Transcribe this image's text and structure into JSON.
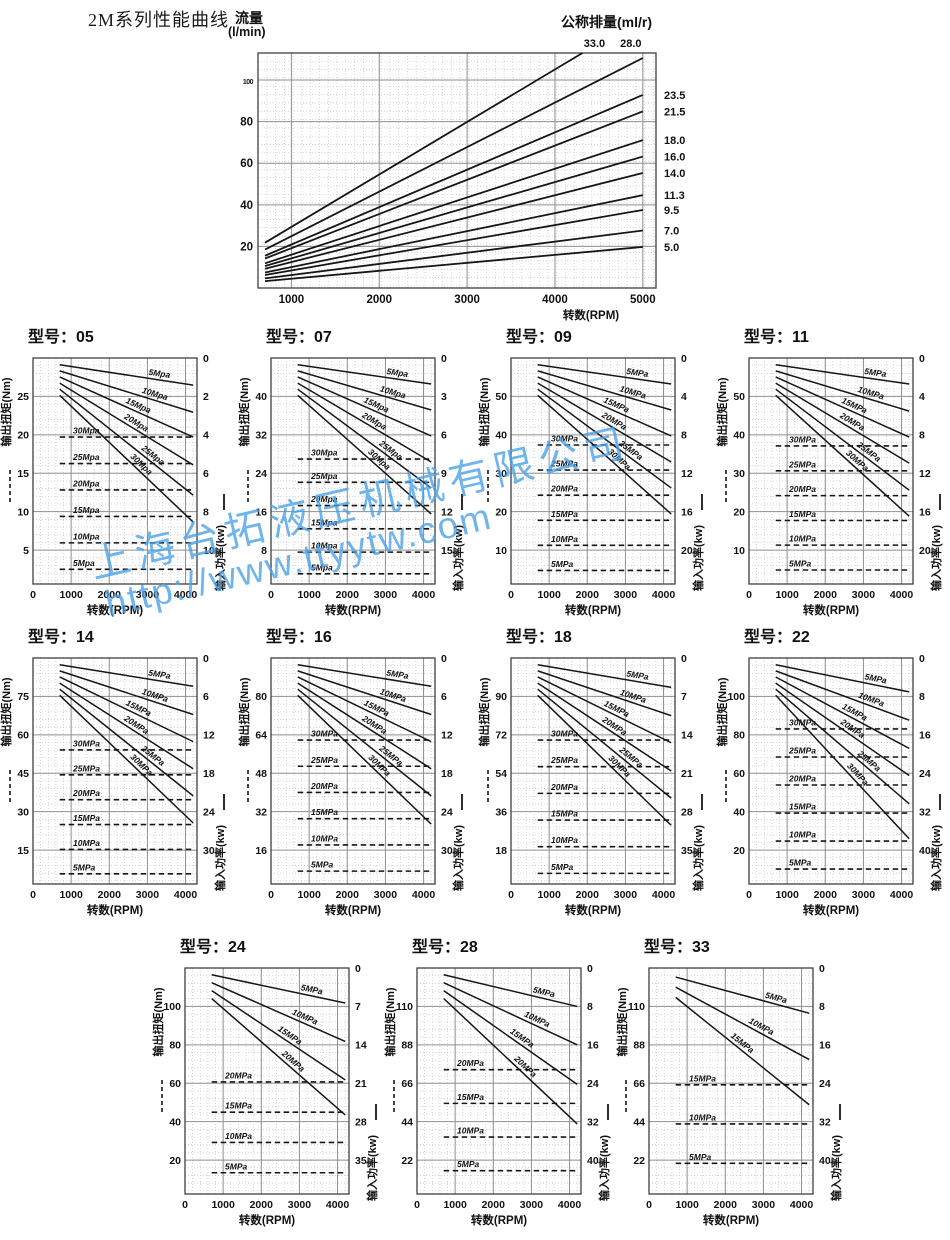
{
  "page": {
    "title": "2M系列性能曲线"
  },
  "watermark": {
    "line1": "上海台拓液压机械有限公司",
    "line2": "http://www.ttyytw.com",
    "color": "#49a0e8"
  },
  "colors": {
    "line": "#161616",
    "grid_major": "#8f8f8f",
    "grid_minor": "#c6c6c6",
    "border": "#3f3f3f"
  },
  "chart_data": {
    "top": {
      "type": "line",
      "title_left_1": "流量",
      "title_left_2": "(l/min)",
      "title_right": "公称排量(ml/r)",
      "xlabel": "转数(RPM)",
      "x_ticks": [
        "1000",
        "2000",
        "3000",
        "4000",
        "5000"
      ],
      "y_ticks": [
        "20",
        "40",
        "60",
        "80",
        "100"
      ],
      "x_range_rpm": [
        620,
        5150
      ],
      "y_range_flow": [
        0,
        113
      ],
      "flow_model": {
        "rpm_start": 700,
        "rpm_end": 5000,
        "k_start": 0.66,
        "k_end": 3.95
      },
      "series": [
        {
          "label": "33.0",
          "d": 33.0,
          "label_pos": "top"
        },
        {
          "label": "28.0",
          "d": 28.0,
          "label_pos": "top"
        },
        {
          "label": "23.5",
          "d": 23.5,
          "label_pos": "right"
        },
        {
          "label": "21.5",
          "d": 21.5,
          "label_pos": "right"
        },
        {
          "label": "18.0",
          "d": 18.0,
          "label_pos": "right"
        },
        {
          "label": "16.0",
          "d": 16.0,
          "label_pos": "right"
        },
        {
          "label": "14.0",
          "d": 14.0,
          "label_pos": "right"
        },
        {
          "label": "11.3",
          "d": 11.3,
          "label_pos": "right"
        },
        {
          "label": "9.5",
          "d": 9.5,
          "label_pos": "right"
        },
        {
          "label": "7.0",
          "d": 7.0,
          "label_pos": "right"
        },
        {
          "label": "5.0",
          "d": 5.0,
          "label_pos": "right"
        }
      ]
    },
    "common": {
      "xlabel": "转数(RPM)",
      "x_ticks": [
        "0",
        "1000",
        "2000",
        "3000",
        "4000"
      ],
      "x_range_rpm": [
        0,
        4300
      ],
      "line_start_rpm": 700,
      "line_end_rpm": 4200,
      "left_axis_label": "输出扭矩(Nm)",
      "right_axis_label": "输入功率(kw)"
    },
    "models": [
      {
        "id": "05",
        "title": "型号：05",
        "left_ticks": [
          "25",
          "20",
          "15",
          "10",
          "5"
        ],
        "right_ticks": [
          "0",
          "2",
          "4",
          "6",
          "8",
          "10"
        ],
        "solid": [
          {
            "label": "5Mpa",
            "s": 0.03,
            "e": 0.12
          },
          {
            "label": "10Mpa",
            "s": 0.057,
            "e": 0.24
          },
          {
            "label": "15Mpa",
            "s": 0.084,
            "e": 0.35
          },
          {
            "label": "20Mpa",
            "s": 0.111,
            "e": 0.473
          },
          {
            "label": "25Mpa",
            "s": 0.138,
            "e": 0.607
          },
          {
            "label": "30Mpa",
            "s": 0.165,
            "e": 0.726
          }
        ],
        "dashed": [
          {
            "label": "30Mpa",
            "f": 0.35
          },
          {
            "label": "25Mpa",
            "f": 0.467
          },
          {
            "label": "20Mpa",
            "f": 0.584
          },
          {
            "label": "15Mpa",
            "f": 0.701
          },
          {
            "label": "10Mpa",
            "f": 0.818
          },
          {
            "label": "5Mpa",
            "f": 0.935
          }
        ]
      },
      {
        "id": "07",
        "title": "型号：07",
        "left_ticks": [
          "40",
          "32",
          "24",
          "16",
          "8"
        ],
        "right_ticks": [
          "0",
          "3",
          "6",
          "9",
          "12",
          "15"
        ],
        "solid": [
          {
            "label": "5Mpa",
            "s": 0.03,
            "e": 0.115
          },
          {
            "label": "10Mpa",
            "s": 0.057,
            "e": 0.23
          },
          {
            "label": "15Mpa",
            "s": 0.084,
            "e": 0.345
          },
          {
            "label": "20Mpa",
            "s": 0.111,
            "e": 0.46
          },
          {
            "label": "25Mpa",
            "s": 0.138,
            "e": 0.575
          },
          {
            "label": "30Mpa",
            "s": 0.165,
            "e": 0.69
          }
        ],
        "dashed": [
          {
            "label": "30Mpa",
            "f": 0.447
          },
          {
            "label": "25Mpa",
            "f": 0.55
          },
          {
            "label": "20Mpa",
            "f": 0.653
          },
          {
            "label": "15Mpa",
            "f": 0.756
          },
          {
            "label": "10Mpa",
            "f": 0.859
          },
          {
            "label": "5Mpa",
            "f": 0.955
          }
        ]
      },
      {
        "id": "09",
        "title": "型号：09",
        "left_ticks": [
          "50",
          "40",
          "30",
          "20",
          "10"
        ],
        "right_ticks": [
          "0",
          "4",
          "8",
          "12",
          "16",
          "20"
        ],
        "solid": [
          {
            "label": "5MPa",
            "s": 0.03,
            "e": 0.115
          },
          {
            "label": "10MPa",
            "s": 0.057,
            "e": 0.23
          },
          {
            "label": "15MPa",
            "s": 0.084,
            "e": 0.345
          },
          {
            "label": "20MPa",
            "s": 0.111,
            "e": 0.46
          },
          {
            "label": "25MPa",
            "s": 0.138,
            "e": 0.575
          },
          {
            "label": "30MPa",
            "s": 0.165,
            "e": 0.69
          }
        ],
        "dashed": [
          {
            "label": "30MPa",
            "f": 0.385
          },
          {
            "label": "25MPa",
            "f": 0.496
          },
          {
            "label": "20MPa",
            "f": 0.607
          },
          {
            "label": "15MPa",
            "f": 0.718
          },
          {
            "label": "10MPa",
            "f": 0.829
          },
          {
            "label": "5MPa",
            "f": 0.94
          }
        ]
      },
      {
        "id": "11",
        "title": "型号：11",
        "left_ticks": [
          "50",
          "40",
          "30",
          "20",
          "10"
        ],
        "right_ticks": [
          "0",
          "4",
          "8",
          "12",
          "16",
          "20"
        ],
        "solid": [
          {
            "label": "5MPa",
            "s": 0.03,
            "e": 0.115
          },
          {
            "label": "10MPa",
            "s": 0.057,
            "e": 0.235
          },
          {
            "label": "15MPa",
            "s": 0.084,
            "e": 0.35
          },
          {
            "label": "20MPa",
            "s": 0.111,
            "e": 0.465
          },
          {
            "label": "25MPa",
            "s": 0.138,
            "e": 0.585
          },
          {
            "label": "30MPa",
            "s": 0.165,
            "e": 0.7
          }
        ],
        "dashed": [
          {
            "label": "30MPa",
            "f": 0.389
          },
          {
            "label": "25MPa",
            "f": 0.499
          },
          {
            "label": "20MPa",
            "f": 0.609
          },
          {
            "label": "15MPa",
            "f": 0.719
          },
          {
            "label": "10MPa",
            "f": 0.828
          },
          {
            "label": "5MPa",
            "f": 0.938
          }
        ]
      },
      {
        "id": "14",
        "title": "型号：14",
        "left_ticks": [
          "75",
          "60",
          "45",
          "30",
          "15"
        ],
        "right_ticks": [
          "0",
          "6",
          "12",
          "18",
          "24",
          "30"
        ],
        "solid": [
          {
            "label": "5MPa",
            "s": 0.03,
            "e": 0.125
          },
          {
            "label": "10MPa",
            "s": 0.057,
            "e": 0.25
          },
          {
            "label": "15MPa",
            "s": 0.084,
            "e": 0.37
          },
          {
            "label": "20MPa",
            "s": 0.111,
            "e": 0.49
          },
          {
            "label": "25MPa",
            "s": 0.138,
            "e": 0.61
          },
          {
            "label": "30MPa",
            "s": 0.165,
            "e": 0.73
          }
        ],
        "dashed": [
          {
            "label": "30MPa",
            "f": 0.407
          },
          {
            "label": "25MPa",
            "f": 0.517
          },
          {
            "label": "20MPa",
            "f": 0.627
          },
          {
            "label": "15MPa",
            "f": 0.737
          },
          {
            "label": "10MPa",
            "f": 0.847
          },
          {
            "label": "5MPa",
            "f": 0.955
          }
        ]
      },
      {
        "id": "16",
        "title": "型号：16",
        "left_ticks": [
          "80",
          "64",
          "48",
          "32",
          "16"
        ],
        "right_ticks": [
          "0",
          "6",
          "12",
          "18",
          "24",
          "30"
        ],
        "solid": [
          {
            "label": "5MPa",
            "s": 0.03,
            "e": 0.125
          },
          {
            "label": "10MPa",
            "s": 0.057,
            "e": 0.25
          },
          {
            "label": "15MPa",
            "s": 0.084,
            "e": 0.37
          },
          {
            "label": "20MPa",
            "s": 0.111,
            "e": 0.49
          },
          {
            "label": "25MPa",
            "s": 0.138,
            "e": 0.61
          },
          {
            "label": "30MPa",
            "s": 0.165,
            "e": 0.735
          }
        ],
        "dashed": [
          {
            "label": "30MPa",
            "f": 0.363
          },
          {
            "label": "25MPa",
            "f": 0.479
          },
          {
            "label": "20MPa",
            "f": 0.595
          },
          {
            "label": "15MPa",
            "f": 0.711
          },
          {
            "label": "10MPa",
            "f": 0.827
          },
          {
            "label": "5MPa",
            "f": 0.943
          }
        ]
      },
      {
        "id": "18",
        "title": "型号：18",
        "left_ticks": [
          "90",
          "72",
          "54",
          "36",
          "18"
        ],
        "right_ticks": [
          "0",
          "7",
          "14",
          "21",
          "28",
          "35"
        ],
        "solid": [
          {
            "label": "5MPa",
            "s": 0.03,
            "e": 0.13
          },
          {
            "label": "10MPa",
            "s": 0.057,
            "e": 0.255
          },
          {
            "label": "15MPa",
            "s": 0.084,
            "e": 0.375
          },
          {
            "label": "20MPa",
            "s": 0.111,
            "e": 0.5
          },
          {
            "label": "25MPa",
            "s": 0.138,
            "e": 0.62
          },
          {
            "label": "30MPa",
            "s": 0.165,
            "e": 0.74
          }
        ],
        "dashed": [
          {
            "label": "30MPa",
            "f": 0.363
          },
          {
            "label": "25MPa",
            "f": 0.481
          },
          {
            "label": "20MPa",
            "f": 0.599
          },
          {
            "label": "15MPa",
            "f": 0.717
          },
          {
            "label": "10MPa",
            "f": 0.835
          },
          {
            "label": "5MPa",
            "f": 0.953
          }
        ]
      },
      {
        "id": "22",
        "title": "型号：22",
        "left_ticks": [
          "100",
          "80",
          "60",
          "40",
          "20"
        ],
        "right_ticks": [
          "0",
          "8",
          "16",
          "24",
          "32",
          "40"
        ],
        "solid": [
          {
            "label": "5MPa",
            "s": 0.03,
            "e": 0.15
          },
          {
            "label": "10MPa",
            "s": 0.057,
            "e": 0.275
          },
          {
            "label": "15MPa",
            "s": 0.084,
            "e": 0.4
          },
          {
            "label": "20MPa",
            "s": 0.111,
            "e": 0.52
          },
          {
            "label": "25MPa",
            "s": 0.138,
            "e": 0.645
          },
          {
            "label": "30MPa",
            "s": 0.165,
            "e": 0.8
          }
        ],
        "dashed": [
          {
            "label": "30MPa",
            "f": 0.314
          },
          {
            "label": "25MPa",
            "f": 0.438
          },
          {
            "label": "20MPa",
            "f": 0.562
          },
          {
            "label": "15MPa",
            "f": 0.686
          },
          {
            "label": "10MPa",
            "f": 0.81
          },
          {
            "label": "5MPa",
            "f": 0.934
          }
        ]
      },
      {
        "id": "24",
        "title": "型号：24",
        "left_ticks": [
          "100",
          "80",
          "60",
          "40",
          "20"
        ],
        "right_ticks": [
          "0",
          "7",
          "14",
          "21",
          "28",
          "35"
        ],
        "solid": [
          {
            "label": "5MPa",
            "s": 0.03,
            "e": 0.155
          },
          {
            "label": "10MPa",
            "s": 0.065,
            "e": 0.325
          },
          {
            "label": "15MPa",
            "s": 0.1,
            "e": 0.495
          },
          {
            "label": "20MPa",
            "s": 0.135,
            "e": 0.65
          }
        ],
        "dashed": [
          {
            "label": "20MPa",
            "f": 0.504
          },
          {
            "label": "15MPa",
            "f": 0.638
          },
          {
            "label": "10MPa",
            "f": 0.772
          },
          {
            "label": "5MPa",
            "f": 0.906
          }
        ]
      },
      {
        "id": "28",
        "title": "型号：28",
        "left_ticks": [
          "110",
          "88",
          "66",
          "44",
          "22"
        ],
        "right_ticks": [
          "0",
          "8",
          "16",
          "24",
          "32",
          "40"
        ],
        "solid": [
          {
            "label": "5MPa",
            "s": 0.03,
            "e": 0.17
          },
          {
            "label": "10MPa",
            "s": 0.065,
            "e": 0.34
          },
          {
            "label": "15MPa",
            "s": 0.1,
            "e": 0.515
          },
          {
            "label": "20MPa",
            "s": 0.135,
            "e": 0.69
          }
        ],
        "dashed": [
          {
            "label": "20MPa",
            "f": 0.45
          },
          {
            "label": "15MPa",
            "f": 0.599
          },
          {
            "label": "10MPa",
            "f": 0.748
          },
          {
            "label": "5MPa",
            "f": 0.897
          }
        ]
      },
      {
        "id": "33",
        "title": "型号：33",
        "left_ticks": [
          "110",
          "88",
          "66",
          "44",
          "22"
        ],
        "right_ticks": [
          "0",
          "8",
          "16",
          "24",
          "32",
          "40"
        ],
        "solid": [
          {
            "label": "5MPa",
            "s": 0.04,
            "e": 0.2
          },
          {
            "label": "10MPa",
            "s": 0.085,
            "e": 0.405
          },
          {
            "label": "15MPa",
            "s": 0.13,
            "e": 0.605
          }
        ],
        "dashed": [
          {
            "label": "15MPa",
            "f": 0.517
          },
          {
            "label": "10MPa",
            "f": 0.69
          },
          {
            "label": "5MPa",
            "f": 0.864
          }
        ]
      }
    ]
  }
}
